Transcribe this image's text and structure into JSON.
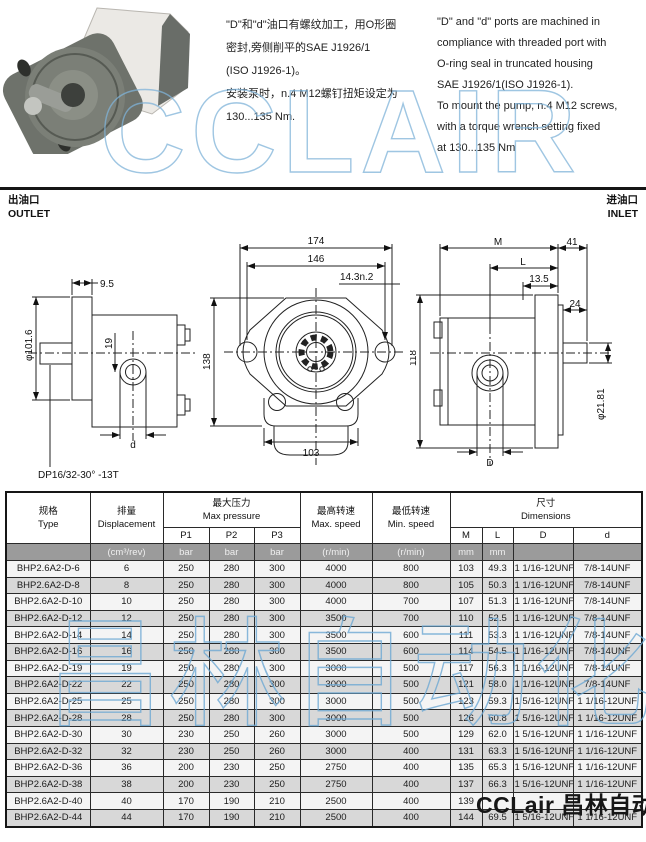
{
  "notes": {
    "cn": [
      "\"D\"和\"d\"油口有螺纹加工，用O形圈",
      "密封,旁侧削平的SAE J1926/1",
      "(ISO J1926-1)。",
      "安装泵时，n.4 M12螺钉扭矩设定为",
      "130...135 Nm."
    ],
    "en": [
      "\"D\" and \"d\" ports are machined in",
      "compliance with threaded port with",
      "O-ring seal in truncated housing",
      "SAE J1926/1(ISO J1926-1).",
      "To mount the pump, n.4 M12 screws,",
      "with a torque wrench setting fixed",
      "at 130...135 Nm"
    ]
  },
  "port_labels": {
    "outlet_cn": "出油口",
    "outlet_en": "OUTLET",
    "inlet_cn": "进油口",
    "inlet_en": "INLET"
  },
  "drawings": {
    "left": {
      "dim_9_5": "9.5",
      "dim_19": "19",
      "dim_dia": "φ101.6",
      "dim_d": "d",
      "spline_note": "DP16/32-30°  -13T"
    },
    "front": {
      "dim_174": "174",
      "dim_146": "146",
      "dim_holes": "14.3n.2",
      "dim_138": "138",
      "dim_103": "103"
    },
    "right": {
      "dim_M": "M",
      "dim_41": "41",
      "dim_L": "L",
      "dim_13_5": "13.5",
      "dim_24": "24",
      "dim_118": "118",
      "dim_dia": "φ21.81",
      "dim_D": "D"
    }
  },
  "watermarks": {
    "top": "CCLAIR",
    "middle": "昌林自动化",
    "bottom": "CCLair 昌林自动化",
    "blue": "#7fb3d9"
  },
  "table": {
    "headers": {
      "type_cn": "规格",
      "type_en": "Type",
      "disp_cn": "排量",
      "disp_en": "Displacement",
      "maxp_cn": "最大压力",
      "maxp_en": "Max pressure",
      "p1": "P1",
      "p2": "P2",
      "p3": "P3",
      "maxs_cn": "最高转速",
      "maxs_en": "Max. speed",
      "mins_cn": "最低转速",
      "mins_en": "Min. speed",
      "dims_cn": "尺寸",
      "dims_en": "Dimensions",
      "m": "M",
      "l": "L",
      "d_big": "D",
      "d_small": "d"
    },
    "units": {
      "disp": "(cm³/rev)",
      "p1": "bar",
      "p2": "bar",
      "p3": "bar",
      "maxs": "(r/min)",
      "mins": "(r/min)",
      "m": "mm",
      "l": "mm",
      "d_big": "",
      "d_small": ""
    },
    "rows": [
      [
        "BHP2.6A2-D-6",
        "6",
        "250",
        "280",
        "300",
        "4000",
        "800",
        "103",
        "49.3",
        "1 1/16-12UNF",
        "7/8-14UNF"
      ],
      [
        "BHP2.6A2-D-8",
        "8",
        "250",
        "280",
        "300",
        "4000",
        "800",
        "105",
        "50.3",
        "1 1/16-12UNF",
        "7/8-14UNF"
      ],
      [
        "BHP2.6A2-D-10",
        "10",
        "250",
        "280",
        "300",
        "4000",
        "700",
        "107",
        "51.3",
        "1 1/16-12UNF",
        "7/8-14UNF"
      ],
      [
        "BHP2.6A2-D-12",
        "12",
        "250",
        "280",
        "300",
        "3500",
        "700",
        "110",
        "52.5",
        "1 1/16-12UNF",
        "7/8-14UNF"
      ],
      [
        "BHP2.6A2-D-14",
        "14",
        "250",
        "280",
        "300",
        "3500",
        "600",
        "111",
        "53.3",
        "1 1/16-12UNF",
        "7/8-14UNF"
      ],
      [
        "BHP2.6A2-D-16",
        "16",
        "250",
        "280",
        "300",
        "3500",
        "600",
        "114",
        "54.5",
        "1 1/16-12UNF",
        "7/8-14UNF"
      ],
      [
        "BHP2.6A2-D-19",
        "19",
        "250",
        "280",
        "300",
        "3000",
        "500",
        "117",
        "56.3",
        "1 1/16-12UNF",
        "7/8-14UNF"
      ],
      [
        "BHP2.6A2-D-22",
        "22",
        "250",
        "280",
        "300",
        "3000",
        "500",
        "121",
        "58.0",
        "1 1/16-12UNF",
        "7/8-14UNF"
      ],
      [
        "BHP2.6A2-D-25",
        "25",
        "250",
        "280",
        "300",
        "3000",
        "500",
        "123",
        "59.3",
        "1 5/16-12UNF",
        "1 1/16-12UNF"
      ],
      [
        "BHP2.6A2-D-28",
        "28",
        "250",
        "280",
        "300",
        "3000",
        "500",
        "126",
        "60.8",
        "1 5/16-12UNF",
        "1 1/16-12UNF"
      ],
      [
        "BHP2.6A2-D-30",
        "30",
        "230",
        "250",
        "260",
        "3000",
        "500",
        "129",
        "62.0",
        "1 5/16-12UNF",
        "1 1/16-12UNF"
      ],
      [
        "BHP2.6A2-D-32",
        "32",
        "230",
        "250",
        "260",
        "3000",
        "400",
        "131",
        "63.3",
        "1 5/16-12UNF",
        "1 1/16-12UNF"
      ],
      [
        "BHP2.6A2-D-36",
        "36",
        "200",
        "230",
        "250",
        "2750",
        "400",
        "135",
        "65.3",
        "1 5/16-12UNF",
        "1 1/16-12UNF"
      ],
      [
        "BHP2.6A2-D-38",
        "38",
        "200",
        "230",
        "250",
        "2750",
        "400",
        "137",
        "66.3",
        "1 5/16-12UNF",
        "1 1/16-12UNF"
      ],
      [
        "BHP2.6A2-D-40",
        "40",
        "170",
        "190",
        "210",
        "2500",
        "400",
        "139",
        "",
        "",
        ""
      ],
      [
        "BHP2.6A2-D-44",
        "44",
        "170",
        "190",
        "210",
        "2500",
        "400",
        "144",
        "69.5",
        "1 5/16-12UNF",
        "1 1/16-12UNF"
      ]
    ]
  }
}
